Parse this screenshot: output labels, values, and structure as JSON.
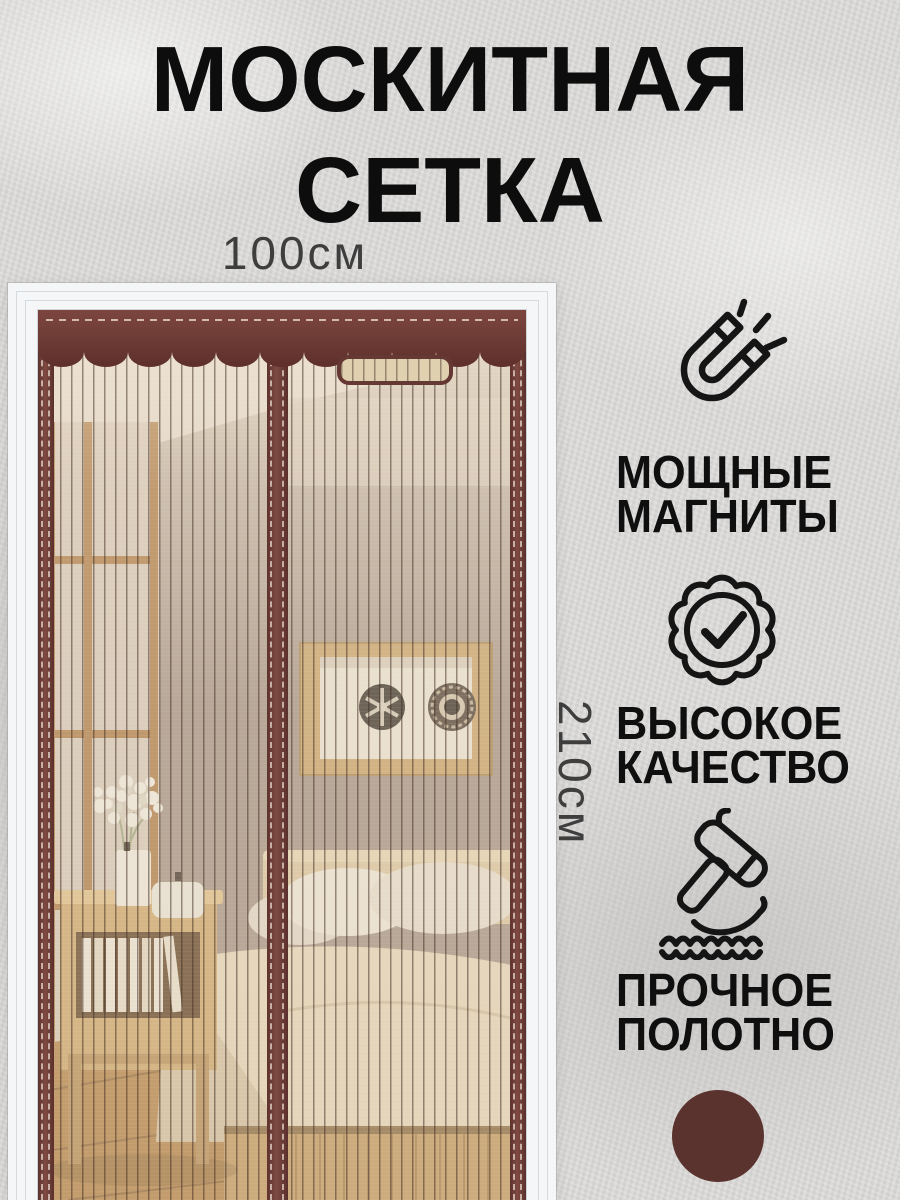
{
  "product": {
    "title_line1": "МОСКИТНАЯ",
    "title_line2": "СЕТКА"
  },
  "dimensions": {
    "width_label": "100см",
    "height_label": "210см"
  },
  "features": [
    {
      "icon": "magnet-icon",
      "line1": "МОЩНЫЕ",
      "line2": "МАГНИТЫ"
    },
    {
      "icon": "quality-badge-icon",
      "line1": "ВЫСОКОЕ",
      "line2": "КАЧЕСТВО"
    },
    {
      "icon": "hammer-icon",
      "line1": "ПРОЧНОЕ",
      "line2": "ПОЛОТНО"
    }
  ],
  "color_swatch": {
    "hex": "#5a322e"
  },
  "palette": {
    "net_frame": "#6e3b35",
    "mesh": "#d9c7a4",
    "text": "#0f0f0f",
    "background": "#d9d8d6"
  }
}
